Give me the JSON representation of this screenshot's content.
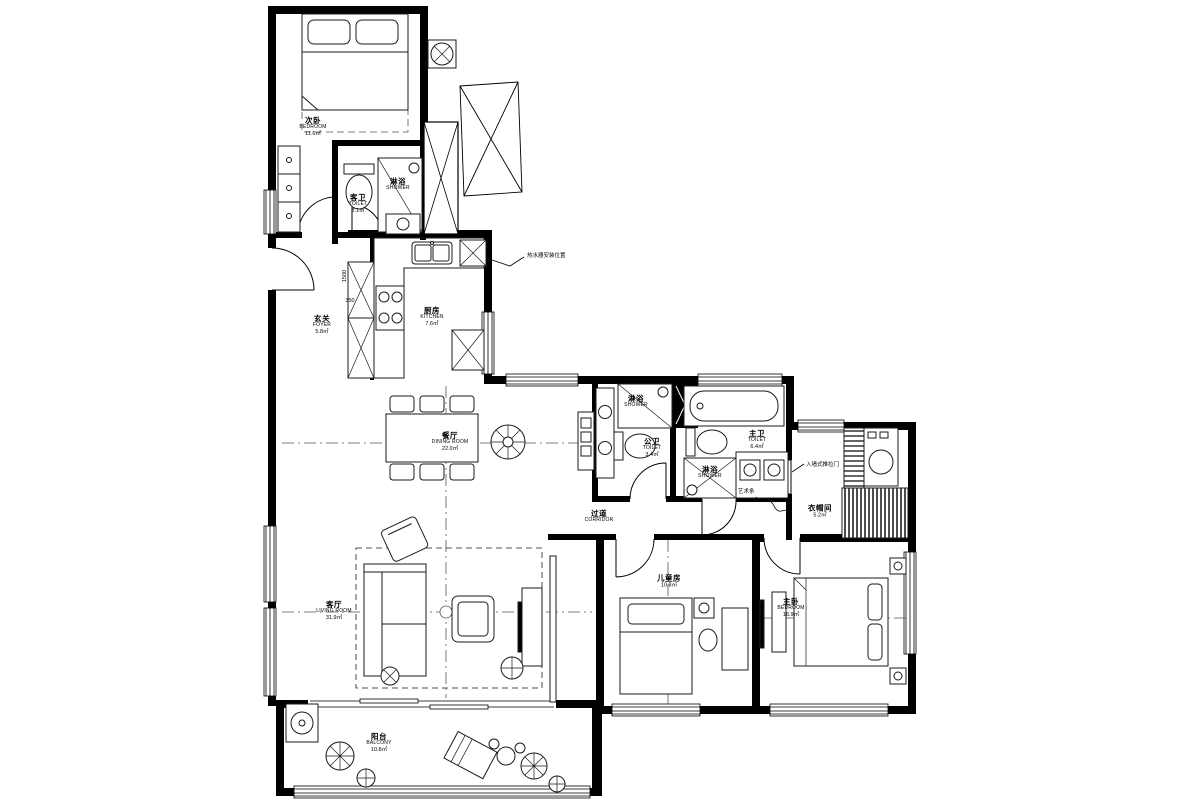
{
  "drawing": {
    "type": "residential floor plan",
    "ink_color": "#000000",
    "background": "#ffffff"
  },
  "rooms": [
    {
      "key": "bedroom2",
      "zh": "次卧",
      "en": "BEDROOM",
      "area": "11.6㎡"
    },
    {
      "key": "shower-guest",
      "zh": "淋浴",
      "en": "SHOWER",
      "area": ""
    },
    {
      "key": "toilet-guest",
      "zh": "客卫",
      "en": "TOILET",
      "area": "3.1㎡"
    },
    {
      "key": "foyer",
      "zh": "玄关",
      "en": "FOYER",
      "area": "5.8㎡"
    },
    {
      "key": "kitchen",
      "zh": "厨房",
      "en": "KITCHEN",
      "area": "7.6㎡"
    },
    {
      "key": "dining-room",
      "zh": "餐厅",
      "en": "DINING ROOM",
      "area": "22.0㎡"
    },
    {
      "key": "shower-public",
      "zh": "淋浴",
      "en": "SHOWER",
      "area": ""
    },
    {
      "key": "toilet-public",
      "zh": "公卫",
      "en": "TOILET",
      "area": "3.4㎡"
    },
    {
      "key": "toilet-master",
      "zh": "主卫",
      "en": "TOILET",
      "area": "6.4㎡"
    },
    {
      "key": "shower-master",
      "zh": "淋浴",
      "en": "SHOWER",
      "area": ""
    },
    {
      "key": "corridor",
      "zh": "过道",
      "en": "CORRIDOR",
      "area": ""
    },
    {
      "key": "cloakroom",
      "zh": "衣帽间",
      "en": "",
      "area": "5.2㎡"
    },
    {
      "key": "living-room",
      "zh": "客厅",
      "en": "LIVING ROOM",
      "area": "31.9㎡"
    },
    {
      "key": "kids-room",
      "zh": "儿童房",
      "en": "",
      "area": "10.8㎡"
    },
    {
      "key": "master-bedroom",
      "zh": "主卧",
      "en": "BEDROOM",
      "area": "16.9㎡"
    },
    {
      "key": "balcony",
      "zh": "阳台",
      "en": "BALCONY",
      "area": "10.8㎡"
    }
  ],
  "annotations": [
    {
      "key": "water-heater",
      "text": "热水器安装位置"
    },
    {
      "key": "pocket-door",
      "text": "入墙式推拉门"
    },
    {
      "key": "art-strip",
      "text": "艺术条"
    }
  ],
  "dimensions": [
    {
      "key": "dim-1500",
      "text": "1500"
    },
    {
      "key": "dim-350",
      "text": "350"
    }
  ]
}
